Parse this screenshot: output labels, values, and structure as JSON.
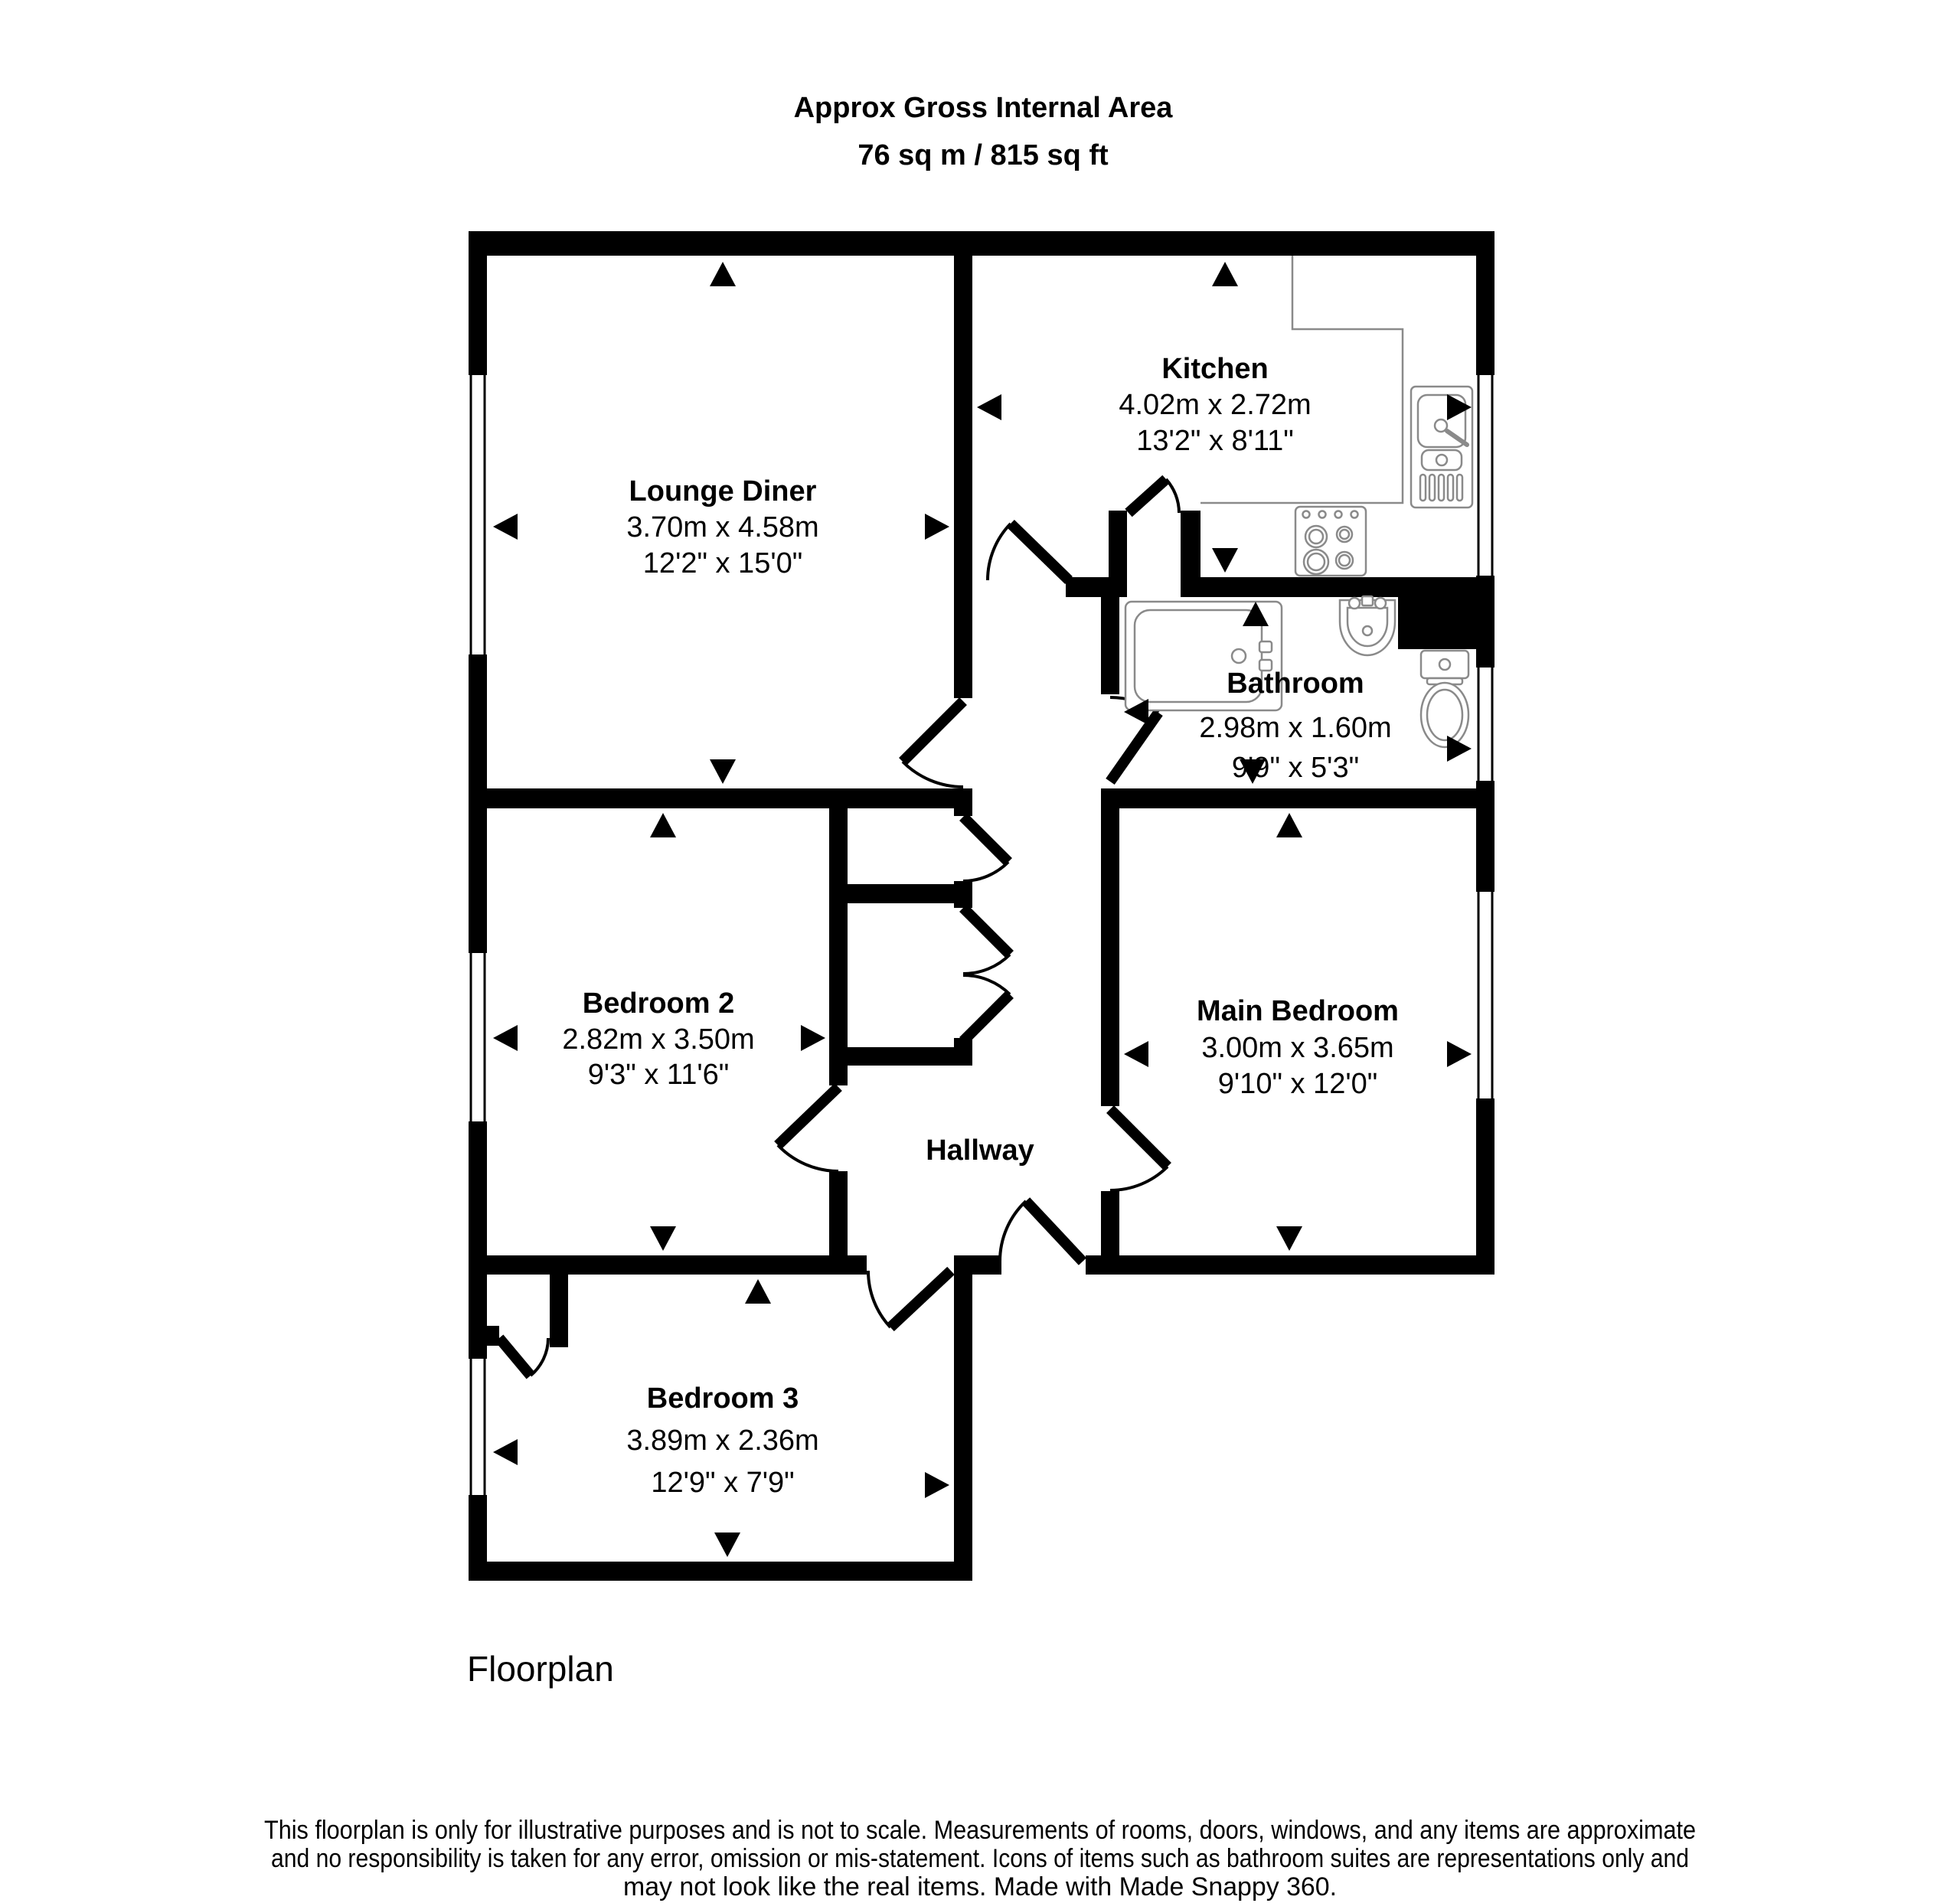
{
  "title": {
    "line1": "Approx Gross Internal Area",
    "line2": "76 sq m / 815 sq ft"
  },
  "rooms": [
    {
      "id": "lounge-diner",
      "name": "Lounge Diner",
      "metric": "3.70m x 4.58m",
      "imperial": "12'2\" x 15'0\""
    },
    {
      "id": "kitchen",
      "name": "Kitchen",
      "metric": "4.02m x 2.72m",
      "imperial": "13'2\" x 8'11\""
    },
    {
      "id": "bathroom",
      "name": "Bathroom",
      "metric": "2.98m x 1.60m",
      "imperial": "9'9\" x 5'3\""
    },
    {
      "id": "bedroom-2",
      "name": "Bedroom 2",
      "metric": "2.82m x 3.50m",
      "imperial": "9'3\" x 11'6\""
    },
    {
      "id": "main-bedroom",
      "name": "Main Bedroom",
      "metric": "3.00m x 3.65m",
      "imperial": "9'10\" x 12'0\""
    },
    {
      "id": "bedroom-3",
      "name": "Bedroom 3",
      "metric": "3.89m x 2.36m",
      "imperial": "12'9\" x 7'9\""
    },
    {
      "id": "hallway",
      "name": "Hallway"
    }
  ],
  "fixtures": [
    "bath-icon",
    "basin-icon",
    "toilet-icon",
    "kitchen-sink-icon",
    "hob-icon",
    "worktop-counter"
  ],
  "footer": {
    "caption": "Floorplan",
    "disclaimer_line1": "This floorplan is only for illustrative purposes and is not to scale. Measurements of rooms, doors, windows, and any items are approximate",
    "disclaimer_line2": "and no responsibility is taken for any error, omission or mis-statement. Icons of items such as bathroom suites are representations only and",
    "disclaimer_line3": "may not look like the real items. Made with Made Snappy 360."
  },
  "colors": {
    "walls": "#000000",
    "fixtures": "#8a8a8a",
    "background": "#ffffff"
  }
}
